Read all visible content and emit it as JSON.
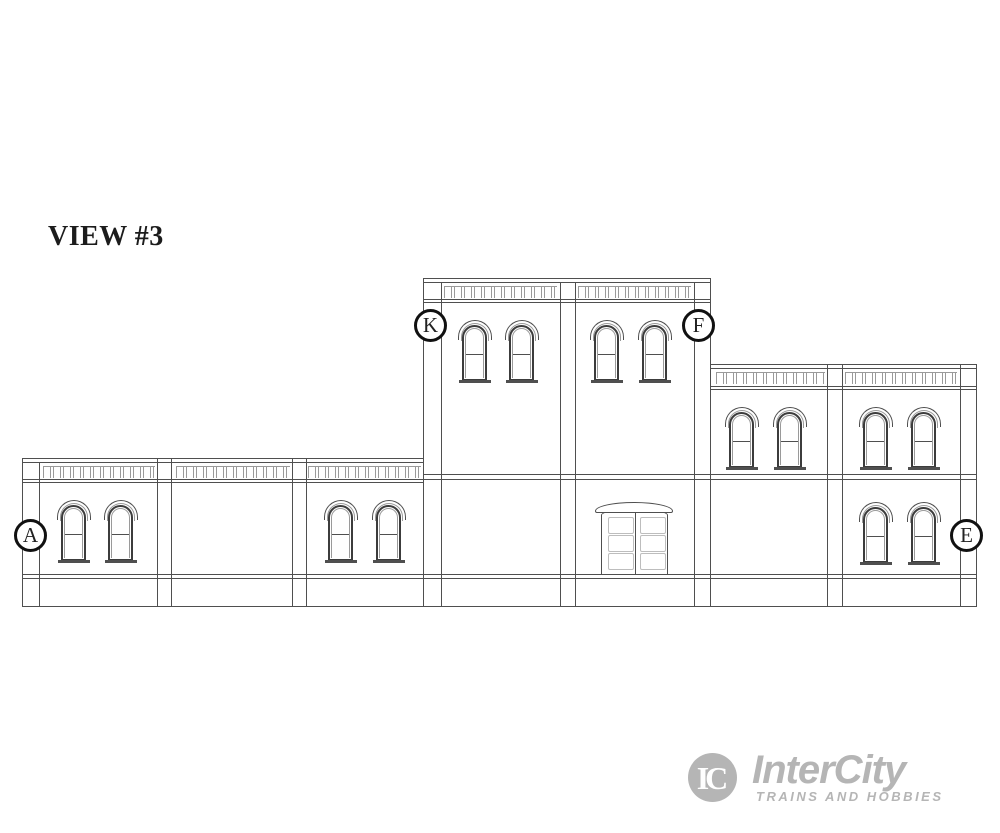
{
  "title": "VIEW #3",
  "callouts": [
    {
      "letter": "A"
    },
    {
      "letter": "K"
    },
    {
      "letter": "F"
    },
    {
      "letter": "E"
    }
  ],
  "logo": {
    "monogram": "IC",
    "name": "InterCity",
    "tagline": "TRAINS AND HOBBIES"
  },
  "colors": {
    "line": "#4f4f4f",
    "line_dark": "#3c3c3c",
    "line_light": "#9a9a9a",
    "panel": "#bdbdbd",
    "logo": "#b5b5b5",
    "text": "#1c1c1c"
  },
  "diagram": {
    "vlines": [
      [
        22,
        458,
        606
      ],
      [
        39,
        462,
        606
      ],
      [
        157,
        458,
        606
      ],
      [
        171,
        458,
        606
      ],
      [
        292,
        458,
        606
      ],
      [
        306,
        458,
        606
      ],
      [
        423,
        278,
        606
      ],
      [
        441,
        282,
        606
      ],
      [
        560,
        282,
        606
      ],
      [
        575,
        282,
        606
      ],
      [
        694,
        282,
        606
      ],
      [
        710,
        278,
        606
      ],
      [
        827,
        364,
        606
      ],
      [
        842,
        364,
        606
      ],
      [
        960,
        364,
        606
      ],
      [
        976,
        364,
        606
      ]
    ],
    "hlines": [
      [
        278,
        423,
        710
      ],
      [
        282,
        423,
        710
      ],
      [
        299,
        423,
        710
      ],
      [
        302,
        423,
        710
      ],
      [
        364,
        710,
        977
      ],
      [
        368,
        710,
        977
      ],
      [
        386,
        710,
        977
      ],
      [
        389,
        710,
        977
      ],
      [
        458,
        22,
        424
      ],
      [
        462,
        22,
        424
      ],
      [
        482,
        22,
        424
      ],
      [
        474,
        423,
        977
      ],
      [
        479,
        22,
        977
      ],
      [
        574,
        22,
        977
      ],
      [
        578,
        22,
        977
      ],
      [
        606,
        22,
        977
      ]
    ],
    "dentils": [
      [
        43,
        155,
        466
      ],
      [
        176,
        290,
        466
      ],
      [
        308,
        421,
        466
      ],
      [
        444,
        557,
        286
      ],
      [
        578,
        691,
        286
      ],
      [
        716,
        825,
        372
      ],
      [
        845,
        957,
        372
      ]
    ],
    "windows": [
      [
        461,
        320
      ],
      [
        508,
        320
      ],
      [
        593,
        320
      ],
      [
        641,
        320
      ],
      [
        60,
        500
      ],
      [
        107,
        500
      ],
      [
        327,
        500
      ],
      [
        375,
        500
      ],
      [
        728,
        407
      ],
      [
        776,
        407
      ],
      [
        862,
        407
      ],
      [
        910,
        407
      ],
      [
        862,
        502
      ],
      [
        910,
        502
      ]
    ],
    "door": {
      "hood": [
        595,
        502
      ],
      "body": [
        601,
        509
      ],
      "panel_offsets": [
        [
          6,
          7
        ],
        [
          38,
          7
        ],
        [
          6,
          25
        ],
        [
          38,
          25
        ],
        [
          6,
          43
        ],
        [
          38,
          43
        ]
      ]
    }
  }
}
